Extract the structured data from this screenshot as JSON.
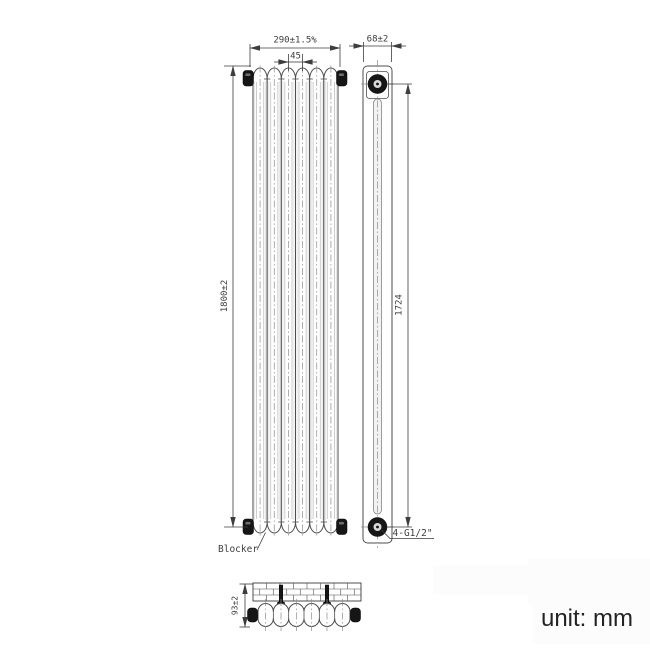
{
  "drawing": {
    "unit_label": "unit: mm",
    "front_view": {
      "columns": 6,
      "dim_width": "290±1.5%",
      "dim_column_pitch": "45",
      "dim_height": "1800±2",
      "blocker_label": "Blocker"
    },
    "side_view": {
      "dim_depth": "68±2",
      "dim_pipe_centers": "1724",
      "connections_label": "4-G1/2\""
    },
    "plan_view": {
      "dim_wall_offset": "93±2",
      "bracket_sections": [
        2,
        5
      ]
    },
    "colors": {
      "line": "#4e4e4e",
      "text": "#3d3d3d",
      "centerline": "#8c8c8c",
      "dark_fill": "#161616",
      "shade": "#cccccc",
      "watermark": "#fcfcfc"
    }
  }
}
